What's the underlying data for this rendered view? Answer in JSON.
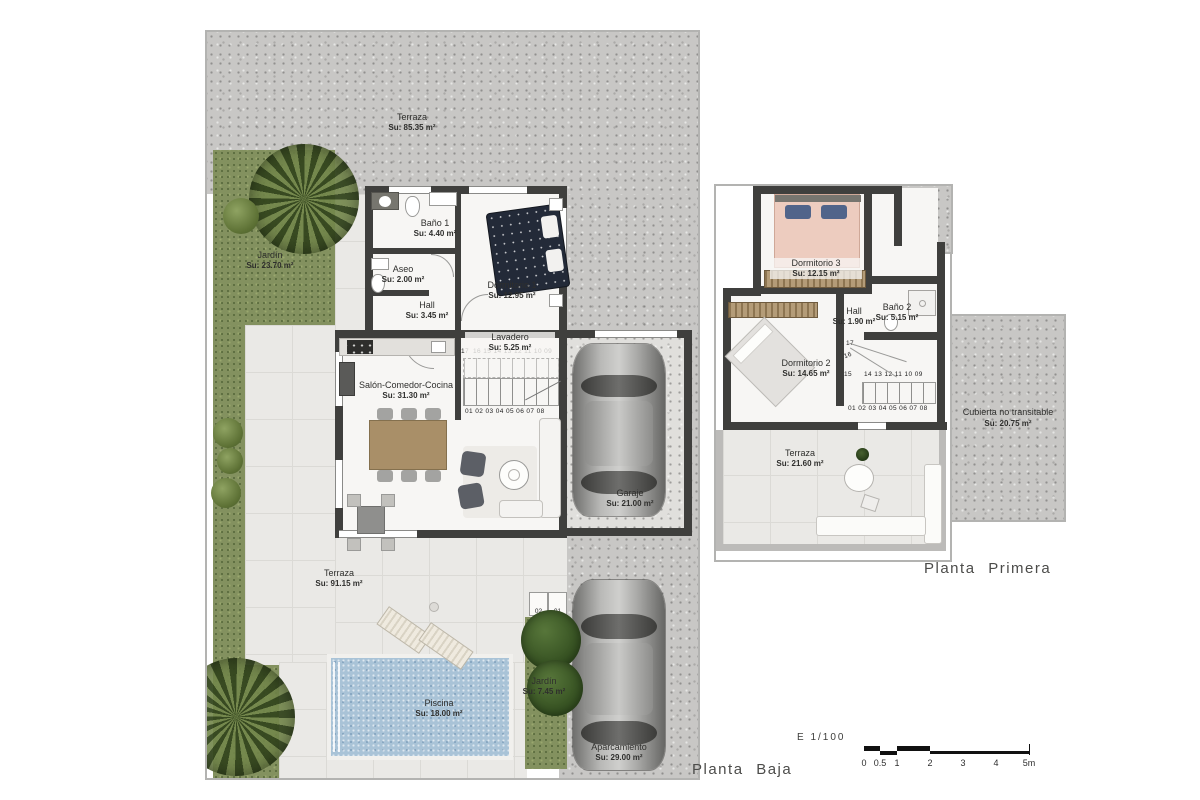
{
  "colors": {
    "wall": "#3f3f3d",
    "concrete": "#c8c7c5",
    "grass": "#83915f",
    "tile": "#eae9e6",
    "tileline": "#dbdad6",
    "interior": "#f7f6f4",
    "pool": "#a9c3d7",
    "plotborder": "#b3b3b1"
  },
  "ground": {
    "title": "Planta Baja",
    "rooms": {
      "terraza_top": {
        "name": "Terraza",
        "area": "Su: 85.35 m²"
      },
      "jardin_left": {
        "name": "Jardín",
        "area": "Su: 23.70 m²"
      },
      "bano1": {
        "name": "Baño 1",
        "area": "Su: 4.40 m²"
      },
      "aseo": {
        "name": "Aseo",
        "area": "Su: 2.00 m²"
      },
      "hall": {
        "name": "Hall",
        "area": "Su: 3.45 m²"
      },
      "dormitorio1": {
        "name": "Dormitorio 1",
        "area": "Su: 12.95 m²"
      },
      "lavadero": {
        "name": "Lavadero",
        "area": "Su: 5.25 m²"
      },
      "salon": {
        "name": "Salón-Comedor-Cocina",
        "area": "Su: 31.30 m²"
      },
      "garaje": {
        "name": "Garaje",
        "area": "Su: 21.00 m²"
      },
      "terraza_main": {
        "name": "Terraza",
        "area": "Su: 91.15 m²"
      },
      "piscina": {
        "name": "Piscina",
        "area": "Su: 18.00 m²"
      },
      "jardin_front": {
        "name": "Jardín",
        "area": "Su: 7.45 m²"
      },
      "aparcamiento": {
        "name": "Aparcamiento",
        "area": "Su: 29.00 m²"
      }
    },
    "stairs": {
      "n17": "17",
      "upper": "16 15 14 13 12 11 10 09",
      "lower": "01 02 03 04 05 06 07 08"
    },
    "steps": [
      "02",
      "01"
    ]
  },
  "first": {
    "title": "Planta Primera",
    "rooms": {
      "dormitorio3": {
        "name": "Dormitorio 3",
        "area": "Su: 12.15 m²"
      },
      "bano2": {
        "name": "Baño 2",
        "area": "Su: 5.15 m²"
      },
      "hall": {
        "name": "Hall",
        "area": "Su: 1.90 m²"
      },
      "dormitorio2": {
        "name": "Dormitorio 2",
        "area": "Su: 14.65 m²"
      },
      "terraza": {
        "name": "Terraza",
        "area": "Su: 21.60 m²"
      },
      "cubierta": {
        "name": "Cubierta no transitable",
        "area": "Su: 20.75 m²"
      }
    },
    "stairs": {
      "n17": "17",
      "n16": "16",
      "n15": "15",
      "upper": "14 13 12 11 10 09",
      "lower": "01 02 03 04 05 06 07 08"
    }
  },
  "scale": {
    "label": "E 1/100",
    "ticks": [
      "0",
      "0.5",
      "1",
      "2",
      "3",
      "4",
      "5m"
    ]
  }
}
